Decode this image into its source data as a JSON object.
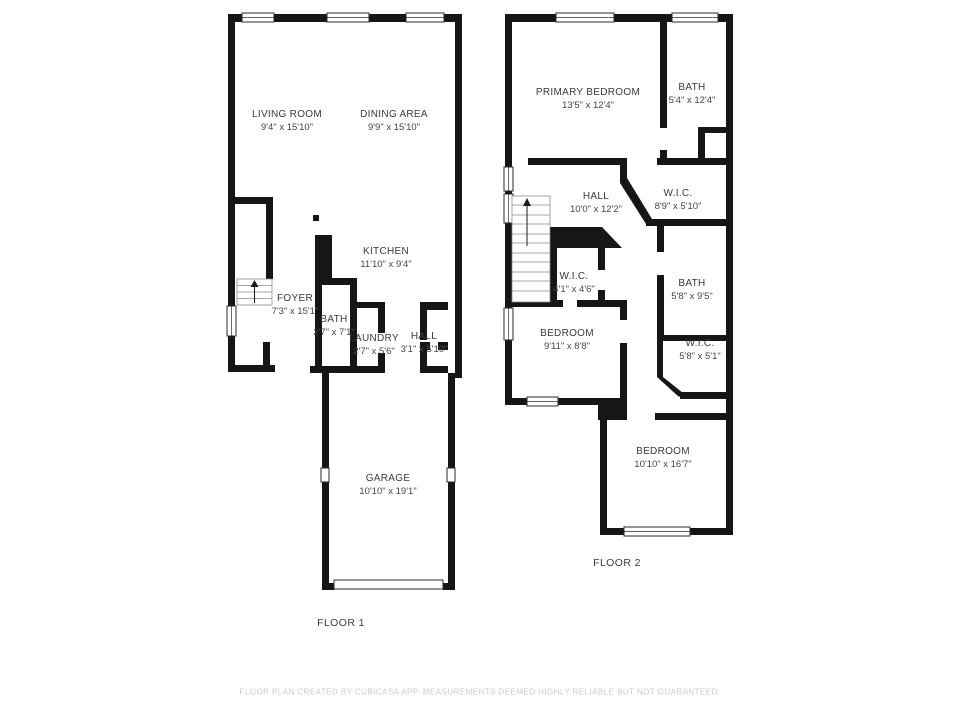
{
  "meta": {
    "app": "CubiCasa floor plan"
  },
  "colors": {
    "wall": "#161616",
    "background": "#ffffff",
    "label": "#3a3a3a",
    "disclaimer": "#cbcbcb"
  },
  "floor1": {
    "label": "FLOOR 1",
    "rooms": [
      {
        "name": "LIVING ROOM",
        "dims": "9'4\" x 15'10\""
      },
      {
        "name": "DINING AREA",
        "dims": "9'9\" x 15'10\""
      },
      {
        "name": "KITCHEN",
        "dims": "11'10\" x 9'4\""
      },
      {
        "name": "FOYER",
        "dims": "7'3\" x 15'1\""
      },
      {
        "name": "BATH",
        "dims": "2'7\" x 7'1\""
      },
      {
        "name": "LAUNDRY",
        "dims": "2'7\" x 5'6\""
      },
      {
        "name": "HALL",
        "dims": "3'1\" x 5'10\""
      },
      {
        "name": "GARAGE",
        "dims": "10'10\" x 19'1\""
      }
    ]
  },
  "floor2": {
    "label": "FLOOR 2",
    "rooms": [
      {
        "name": "PRIMARY BEDROOM",
        "dims": "13'5\" x 12'4\""
      },
      {
        "name": "BATH",
        "dims": "5'4\" x 12'4\""
      },
      {
        "name": "HALL",
        "dims": "10'0\" x 12'2\""
      },
      {
        "name": "W.I.C.",
        "dims": "8'9\" x 5'10\""
      },
      {
        "name": "W.I.C.",
        "dims": "4'1\" x 4'6\""
      },
      {
        "name": "BATH",
        "dims": "5'8\" x 9'5\""
      },
      {
        "name": "BEDROOM",
        "dims": "9'11\" x 8'8\""
      },
      {
        "name": "W.I.C.",
        "dims": "5'8\" x 5'1\""
      },
      {
        "name": "BEDROOM",
        "dims": "10'10\" x 16'7\""
      }
    ]
  },
  "footer": {
    "disclaimer": "FLOOR PLAN CREATED BY CUBICASA APP. MEASUREMENTS DEEMED HIGHLY RELIABLE BUT NOT GUARANTEED."
  }
}
